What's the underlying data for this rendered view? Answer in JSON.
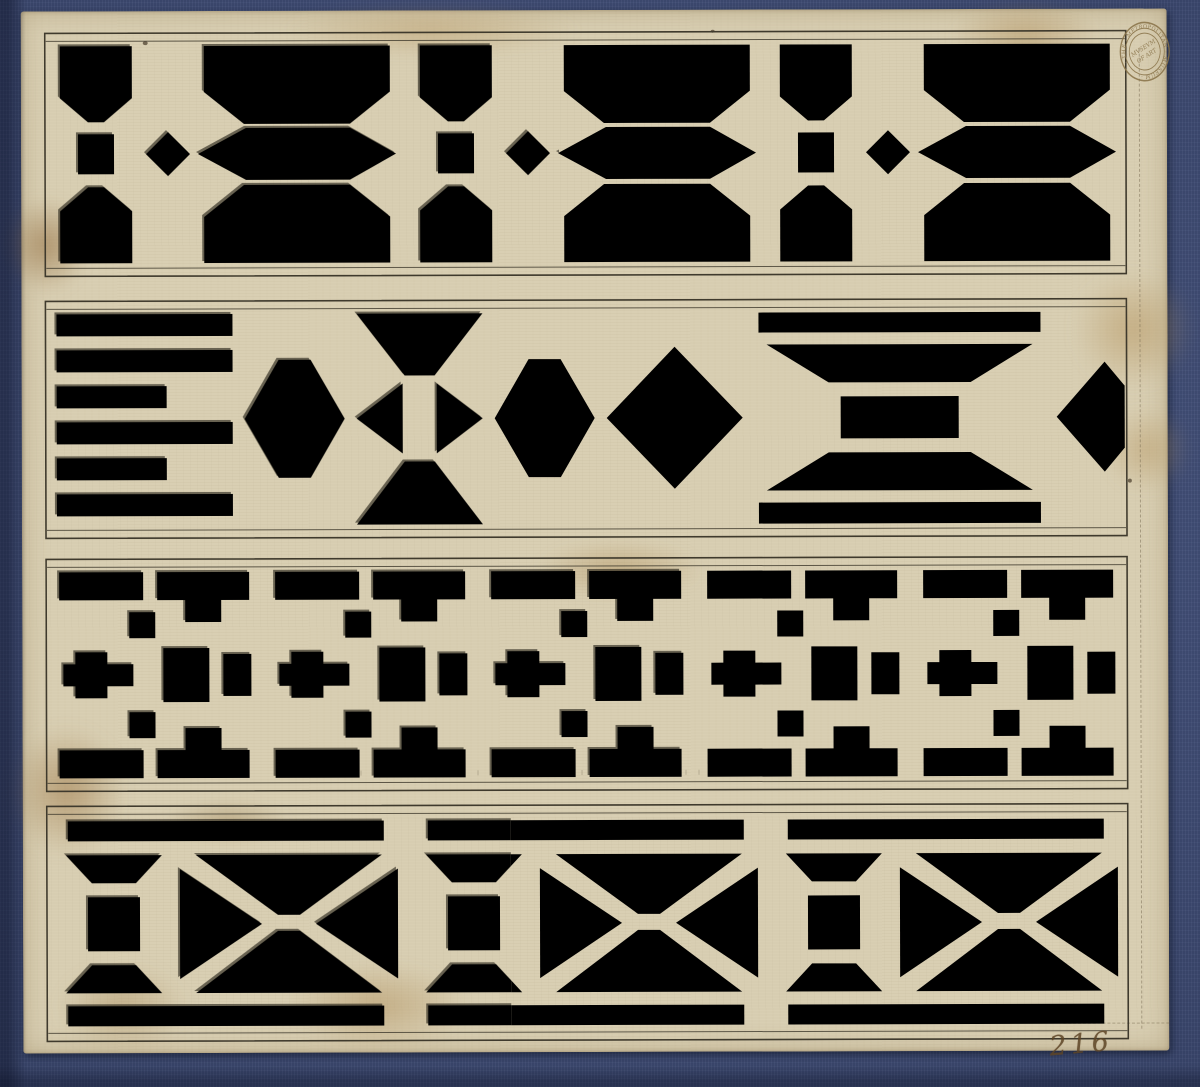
{
  "stamp": {
    "ring_text": "· THE · METROPOLITAN · MUSEUM ·",
    "center_line1": "MVSEVM",
    "center_line2": "OF ART"
  },
  "inscription": {
    "number": "216"
  },
  "colors": {
    "blue": "#41507e",
    "blue-dark": "#2f3d66",
    "paper": "#d9cfb3",
    "paper-edge": "#c9bd9e",
    "wash": "#a9b0a1",
    "wash-dark": "#8e9585",
    "ink": "#4c4435",
    "ink-dark": "#221f17",
    "frame": "#3f3a2d",
    "stain": "#b08d54",
    "stamp": "#8a744a",
    "script-ink": "#5e4526"
  },
  "bands": [
    {
      "name": "band-1",
      "pattern": "chamfered-octagon-lattice"
    },
    {
      "name": "band-2",
      "pattern": "slat-and-diamond-lattice"
    },
    {
      "name": "band-3",
      "pattern": "rectilinear-fret-lattice"
    },
    {
      "name": "band-4",
      "pattern": "diagonal-cross-lattice"
    }
  ]
}
